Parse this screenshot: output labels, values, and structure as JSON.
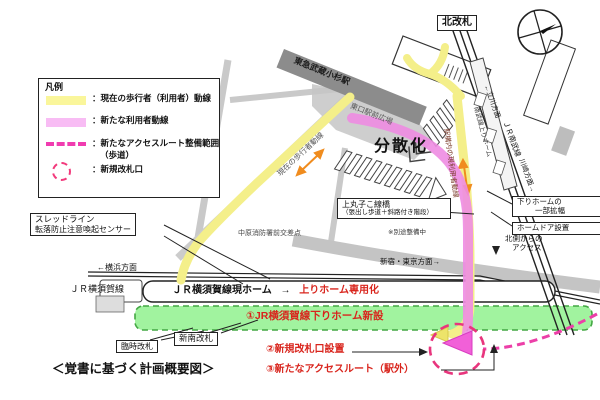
{
  "legend": {
    "title": "凡例",
    "item_current": "：現在の歩行者（利用者）動線",
    "item_new_user": "：新たな利用者動線",
    "item_access_a": "：新たなアクセスルート整備範囲",
    "item_access_b": "（歩道）",
    "item_gate": "：新規改札口",
    "swatch_yellow": "#faf69b",
    "swatch_pink": "#f8bcf4",
    "swatch_dashed": "#f03cb0",
    "swatch_circle": "#f23a7c"
  },
  "top": {
    "north_gate": "北改札",
    "tokyu_station": "東急武蔵小杉駅",
    "east_plaza": "東口駅前広場"
  },
  "center": {
    "dispersal": "分散化",
    "bridge_name": "上丸子こ線橋",
    "bridge_detail": "（張出し歩道＋斜路付き階段）",
    "bridge_note": "※別途整備中",
    "sensor_line1": "スレッドライン",
    "sensor_line2": "転落防止注意喚起センサー",
    "intersection": "中原消防署前交差点",
    "current_flow": "現在の歩行者動線"
  },
  "yokosuka": {
    "dir_left": "←横浜方面",
    "line_name": "ＪＲ横須賀線",
    "dir_right": "新宿・東京方面→",
    "platform_label": "ＪＲ横須賀線現ホーム",
    "platform_arrow": "→",
    "platform_red": "上りホーム専用化",
    "new_platform": "①JR横須賀線下りホーム新設",
    "temp_gate": "臨時改札",
    "new_south_gate": "新南改札"
  },
  "nambu": {
    "dir_top": "←立川方面",
    "up_platform": "南武線上りホーム",
    "line_name": "ＪＲ南武線",
    "dir_bottom": "川崎方面→",
    "station_flow": "駅構内の現利用者動線",
    "north_access_1": "北側からの",
    "north_access_2": "アクセス",
    "widen_1": "下りホームの",
    "widen_2": "一部拡幅",
    "door": "ホームドア設置"
  },
  "bottom": {
    "item2": "②新規改札口設置",
    "item3": "③新たなアクセスルート（駅外）",
    "caption": "＜覚書に基づく計画概要図＞"
  }
}
